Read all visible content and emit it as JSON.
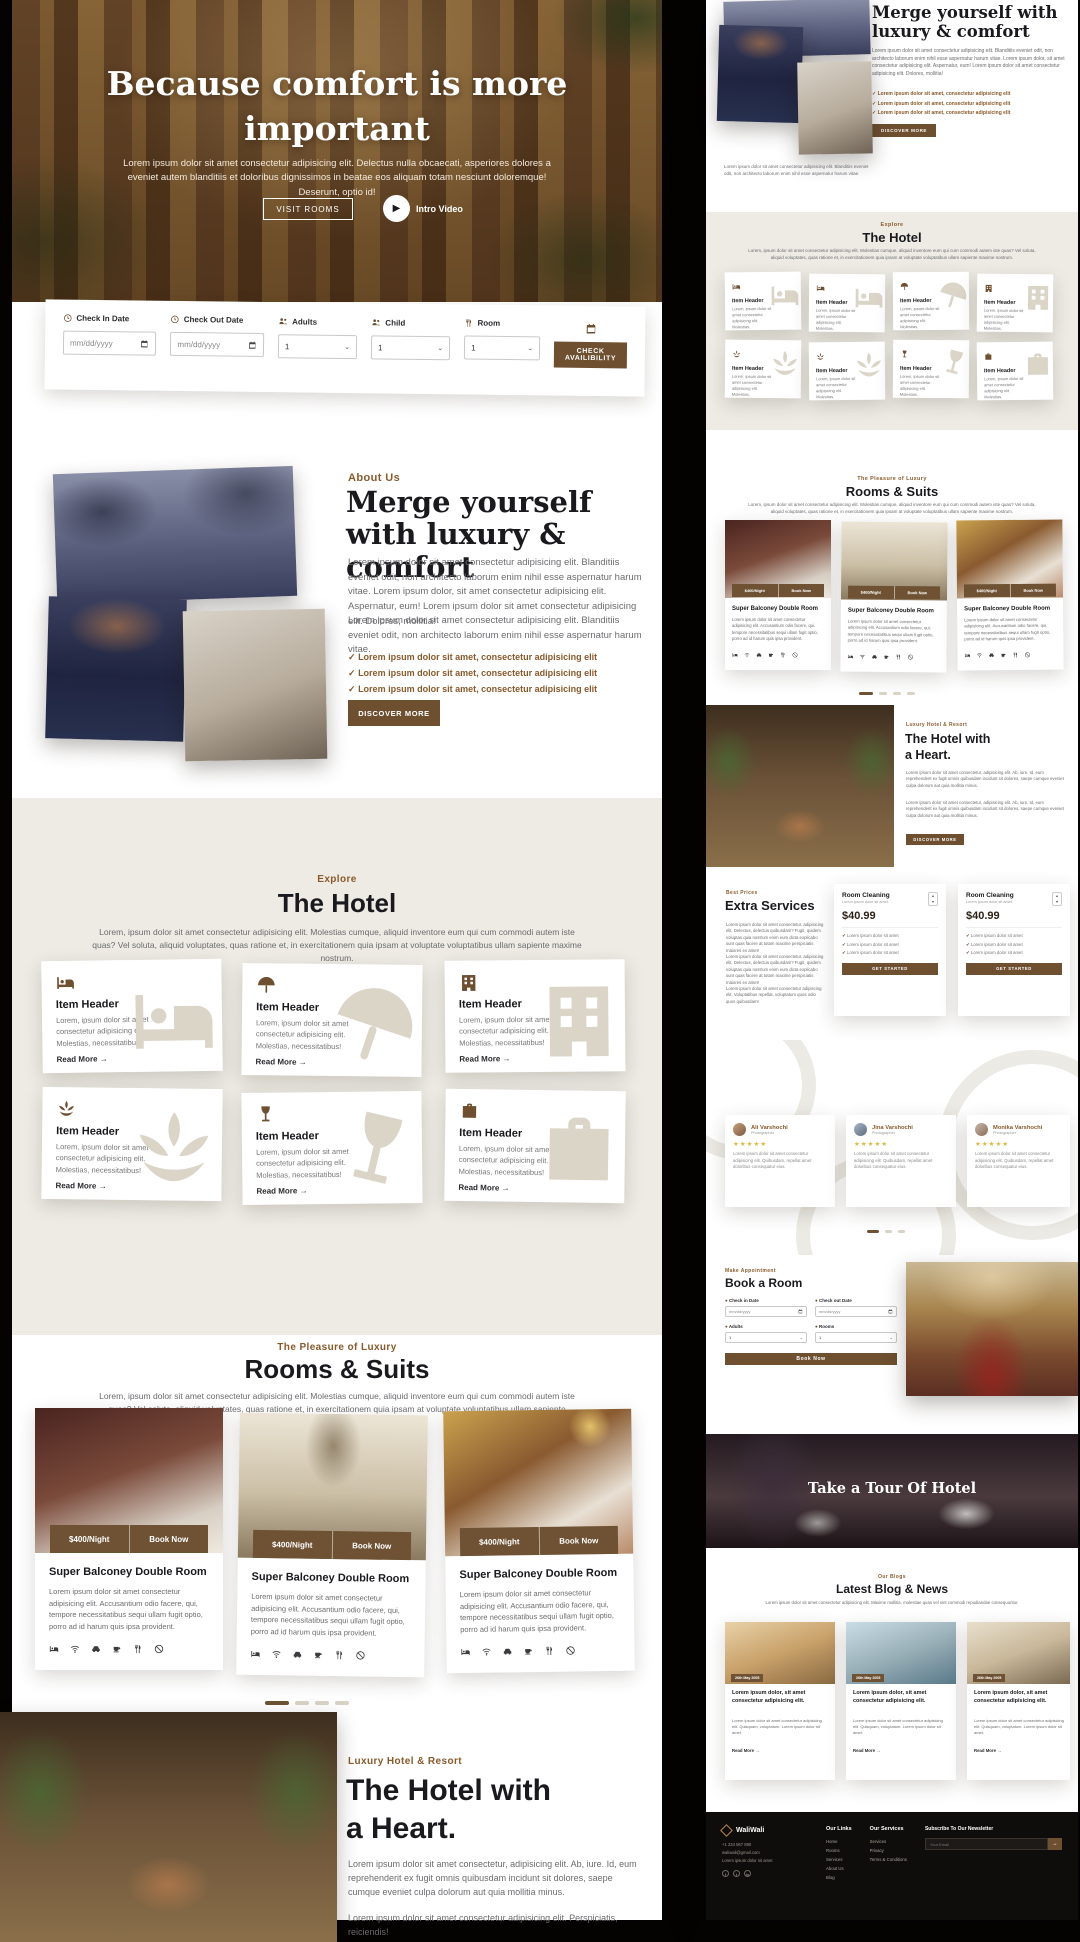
{
  "colors": {
    "accent_brown": "#6e4f30",
    "eyebrow_brown": "#8a5a2b",
    "beige": "#edebe4",
    "icon_beige": "#dbd5c8",
    "star_gold": "#deb841",
    "footer_bg": "#0f0d0b"
  },
  "hero": {
    "title": "Because comfort is more important",
    "subtitle": "Lorem ipsum dolor sit amet consectetur adipisicing elit. Delectus nulla obcaecati, asperiores dolores a eveniet autem blanditiis et doloribus dignissimos in beatae eos aliquam totam nesciunt doloremque! Deserunt, optio id!",
    "visit_rooms": "VISIT ROOMS",
    "intro_video": "Intro Video"
  },
  "booking": {
    "check_in": "Check In Date",
    "check_out": "Check Out Date",
    "adults": "Adults",
    "child": "Child",
    "room": "Room",
    "date_placeholder": "mm/dd/yyyy",
    "guest_value": "1",
    "submit": "CHECK AVAILIBILITY"
  },
  "about": {
    "eyebrow": "About Us",
    "heading": "Merge yourself with luxury & comfort",
    "p1": "Lorem ipsum dolor sit amet consectetur adipisicing elit. Blanditiis eveniet odit, non architecto laborum enim nihil esse aspernatur harum vitae. Lorem ipsum dolor, sit amet consectetur adipisicing elit. Aspernatur, eum! Lorem ipsum dolor sit amet consectetur adipisicing elit. Dolores, mollitia!",
    "p2": "Lorem ipsum dolor sit amet consectetur adipisicing elit. Blanditiis eveniet odit, non architecto laborum enim nihil esse aspernatur harum vitae.",
    "check_item": "Lorem ipsum dolor sit amet, consectetur adipisicing elit",
    "discover": "DISCOVER MORE"
  },
  "explore": {
    "eyebrow": "Explore",
    "heading": "The Hotel",
    "paragraph": "Lorem, ipsum dolor sit amet consectetur adipisicing elit. Molestias cumque, aliquid inventore eum qui cum commodi autem iste quas? Vel soluta, aliquid voluptates, quas ratione et, in exercitationem quia ipsam at voluptate voluptatibus ullam sapiente maxime nostrum.",
    "card_title": "Item Header",
    "card_text": "Lorem, ipsum dolor sit amet consectetur adipisicing elit. Molestias, necessitatibus!",
    "read_more": "Read More",
    "icons": [
      "bed",
      "umbrella",
      "building",
      "leaf",
      "wine",
      "briefcase"
    ]
  },
  "rooms": {
    "eyebrow": "The Pleasure of Luxury",
    "heading": "Rooms & Suits",
    "paragraph": "Lorem, ipsum dolor sit amet consectetur adipisicing elit. Molestias cumque, aliquid inventore eum qui cum commodi autem iste quas? Vel soluta, aliquid voluptates, quas ratione et, in exercitationem quia ipsam at voluptate voluptatibus ullam sapiente maxime nostrum.",
    "price": "$400/Night",
    "book_now": "Book Now",
    "card_title": "Super Balconey Double Room",
    "card_text": "Lorem ipsum dolor sit amet consectetur adipisicing elit. Accusantium odio facere, qui, tempore necessitatibus sequi ullam fugit optio, porro ad id harum quis ipsa provident.",
    "amenities": [
      "bed",
      "wifi",
      "car",
      "coffee",
      "restaurant",
      "no-smoking"
    ]
  },
  "heart": {
    "eyebrow": "Luxury Hotel & Resort",
    "heading_line1": "The Hotel with",
    "heading_line2": "a Heart.",
    "p1": "Lorem ipsum dolor sit amet consectetur, adipisicing elit. Ab, iure. Id, eum reprehenderit ex fugit omnis quibusdam incidunt sit dolores, saepe cumque eveniet culpa dolorum aut quia mollitia minus.",
    "p2": "Lorem ipsum dolor sit amet consectetur adipisicing elit. Perspiciatis, reiciendis!",
    "discover": "DISCOVER MORE"
  },
  "services": {
    "eyebrow": "Best Prices",
    "heading": "Extra Services",
    "p1": "Lorem ipsum dolor sit amet consectetur, adipisicing elit. Delectus, delectus quibusdam? Fugit, quidem voluptas quia nostrum enim eum dicta explicabo sunt quas facere at totam maxime perspiciatis maiores ex amet!",
    "p2": "Lorem ipsum dolor sit amet consectetur, adipisicing elit. Delectus, delectus quibusdam? Fugit, quidem voluptas quia nostrum enim eum dicta explicabo sunt quas facere at totam maxime perspiciatis maiores ex amet!",
    "p3": "Lorem ipsum dolor sit amet consectetur adipiscing elit. Voluptatibus repellat, voluptatum quos odio quos quibusdam!",
    "card_title": "Room Cleaning",
    "card_sub": "Lorem ipsum dolor sit amet.",
    "price": "$40.99",
    "feature": "Lorem ipsum dolor sit amet",
    "cta": "GET STARTED"
  },
  "testimonials": {
    "eyebrow": "Testimonial",
    "heading": "What Our Clients Say",
    "paragraph": "Lorem ipsum dolor sit amet consectetur adipisicing elit. Maxime mollitia, molestiae quas vel sint commodi repudiandae consequuntur.",
    "stars": "★★★★★",
    "role": "Photographer",
    "card_text": "Lorem ipsum dolor sit amet consectetur adipisicing elit. Quibusdam, repellat amet doloribus consequatur eius.",
    "cards": [
      {
        "name": "Ali Varshochi"
      },
      {
        "name": "Jina Varshochi"
      },
      {
        "name": "Monika Varshochi"
      }
    ]
  },
  "book": {
    "eyebrow": "Make Appointment",
    "heading": "Book a Room",
    "check_in": "Check in Date",
    "check_out": "Check out Date",
    "adults": "Adults",
    "rooms_label": "Rooms",
    "date_placeholder": "mm/dd/yyyy",
    "value": "1",
    "submit": "Book Now"
  },
  "tour": {
    "heading": "Take a Tour Of Hotel"
  },
  "blog": {
    "eyebrow": "Our Blogs",
    "heading": "Latest Blog & News",
    "paragraph": "Lorem ipsum dolor sit amet consectetur adipisicing elit. Maxime mollitia, molestiae quas vel sint commodi repudiandae consequuntur.",
    "card_date": "26th May 2005",
    "card_title": "Lorem ipsum dolor, sit amet consectetur adipisicing elit.",
    "card_text": "Lorem ipsum dolor sit amet consectetur adipisicing elit. Quisquam, voluptatum. Lorem ipsum dolor sit amet.",
    "read_more": "Read More"
  },
  "footer": {
    "brand": "WaliWali",
    "contact": [
      "+1 234 567 890",
      "waliwali@gmail.com",
      "Lorem ipsum dolor sit amet"
    ],
    "links_title": "Our Links",
    "links": [
      "Home",
      "Rooms",
      "Services",
      "About Us",
      "Blog"
    ],
    "services_title": "Our Services",
    "services_links": [
      "Services",
      "Privacy",
      "Terms & Conditions"
    ],
    "newsletter_title": "Subscribe To Our Newsletter",
    "newsletter_placeholder": "Your Email"
  }
}
